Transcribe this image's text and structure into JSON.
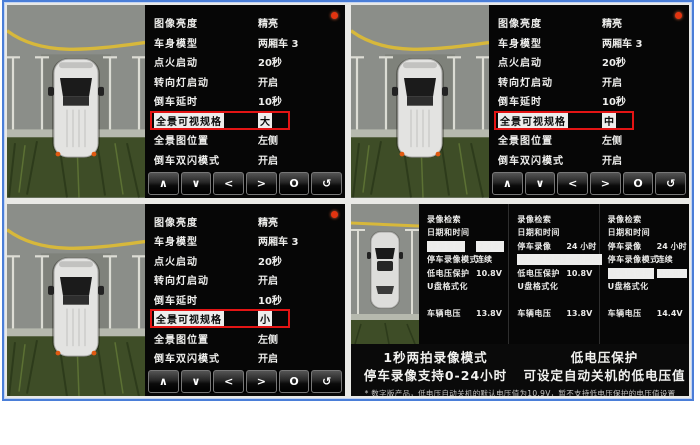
{
  "frame": {
    "border_color": "#4a7ed8",
    "highlight_color": "#e31414",
    "indicator_color": "#e23410"
  },
  "settings_menu": {
    "items": [
      {
        "label": "图像亮度",
        "value": "精亮"
      },
      {
        "label": "车身模型",
        "value": "两厢车 3"
      },
      {
        "label": "点火启动",
        "value": "20秒"
      },
      {
        "label": "转向灯启动",
        "value": "开启"
      },
      {
        "label": "倒车延时",
        "value": "10秒"
      },
      {
        "label": "全景可视规格",
        "value": "",
        "highlighted": true
      },
      {
        "label": "全景图位置",
        "value": "左侧"
      },
      {
        "label": "倒车双闪模式",
        "value": "开启"
      }
    ],
    "screens": [
      {
        "name": "settings-screen-size-large",
        "highlight_value": "大"
      },
      {
        "name": "settings-screen-size-medium",
        "highlight_value": "中"
      },
      {
        "name": "settings-screen-size-small",
        "highlight_value": "小"
      }
    ],
    "navbar": [
      {
        "name": "nav-up-button",
        "glyph": "∧"
      },
      {
        "name": "nav-down-button",
        "glyph": "∨"
      },
      {
        "name": "nav-left-button",
        "glyph": "<"
      },
      {
        "name": "nav-right-button",
        "glyph": ">"
      },
      {
        "name": "nav-ok-button",
        "glyph": "O"
      },
      {
        "name": "nav-back-button",
        "glyph": "↺"
      }
    ]
  },
  "recording": {
    "panels": [
      {
        "rows": [
          {
            "label": "录像检索",
            "value": ""
          },
          {
            "label": "日期和时间",
            "value": ""
          },
          {
            "label": "停车录像",
            "value": "2 小时",
            "highlighted": true
          },
          {
            "label": "停车录像模式",
            "value": "连续"
          },
          {
            "label": "低电压保护",
            "value": "10.8V"
          },
          {
            "label": "U盘格式化",
            "value": ""
          },
          {
            "label": "车辆电压",
            "value": "13.8V",
            "gap": true
          }
        ]
      },
      {
        "rows": [
          {
            "label": "录像检索",
            "value": ""
          },
          {
            "label": "日期和时间",
            "value": ""
          },
          {
            "label": "停车录像",
            "value": "24 小时"
          },
          {
            "label": "停车录像模式",
            "value": "一秒两拍",
            "highlighted": true
          },
          {
            "label": "低电压保护",
            "value": "10.8V"
          },
          {
            "label": "U盘格式化",
            "value": ""
          },
          {
            "label": "车辆电压",
            "value": "13.8V",
            "gap": true
          }
        ]
      },
      {
        "rows": [
          {
            "label": "录像检索",
            "value": ""
          },
          {
            "label": "日期和时间",
            "value": ""
          },
          {
            "label": "停车录像",
            "value": "24 小时"
          },
          {
            "label": "停车录像模式",
            "value": "连续"
          },
          {
            "label": "低电压保护",
            "value": "10.8V",
            "highlighted": true
          },
          {
            "label": "U盘格式化",
            "value": ""
          },
          {
            "label": "车辆电压",
            "value": "14.4V",
            "gap": true
          }
        ]
      }
    ],
    "captions": [
      {
        "line1": "1秒两拍录像模式",
        "line2": "停车录像支持0-24小时"
      },
      {
        "line1": "低电压保护",
        "line2": "可设定自动关机的低电压值"
      }
    ],
    "footnote": "* 数字版产品，低电压自动关机的默认电压值为10.9V，暂不支持低电压保护的电压值设置"
  }
}
